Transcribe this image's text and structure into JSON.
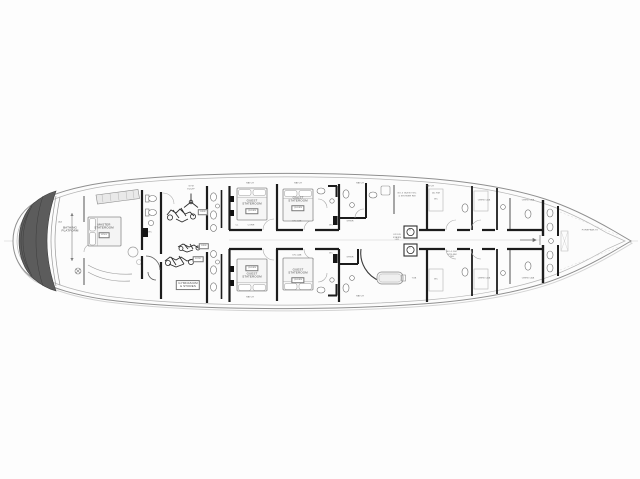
{
  "drawing": {
    "title": "yacht-lower-deck-plan",
    "colors": {
      "background": "#fdfdfd",
      "hull_line": "#8f8f8f",
      "hull_shadow": "#d4d4d4",
      "inner_line": "#b5b5b5",
      "bulkhead": "#1c1c1c",
      "partition": "#3c3c3c",
      "furniture": "#9c9c9c",
      "platform_fill": "#5c5c5c",
      "label_ink": "#4a4a4a"
    },
    "labels": [
      {
        "x": 60,
        "y": 223,
        "text": "LAZ",
        "boxed": false,
        "micro": true
      },
      {
        "x": 70,
        "y": 230,
        "text": "BATHING\nPLATFORM",
        "boxed": false,
        "micro": false
      },
      {
        "x": 104,
        "y": 227,
        "text": "MASTER\nSTATEROOM",
        "boxed": false,
        "micro": false
      },
      {
        "x": 104,
        "y": 235,
        "text": "KING",
        "boxed": true,
        "micro": true
      },
      {
        "x": 150,
        "y": 233,
        "text": "WC",
        "boxed": false,
        "micro": true
      },
      {
        "x": 191,
        "y": 188,
        "text": "GYM\nEQUIP",
        "boxed": false,
        "micro": true
      },
      {
        "x": 203,
        "y": 212,
        "text": "BIKE",
        "boxed": true,
        "micro": true
      },
      {
        "x": 204,
        "y": 246,
        "text": "BIKE",
        "boxed": true,
        "micro": true
      },
      {
        "x": 198,
        "y": 259,
        "text": "ROW",
        "boxed": true,
        "micro": true
      },
      {
        "x": 188,
        "y": 285,
        "text": "GYMNASIUM\n& STORES",
        "boxed": true,
        "micro": false
      },
      {
        "x": 237,
        "y": 226,
        "text": "CL",
        "boxed": false,
        "micro": true
      },
      {
        "x": 251,
        "y": 226,
        "text": "CORR",
        "boxed": false,
        "micro": true
      },
      {
        "x": 252,
        "y": 203,
        "text": "GUEST\nSTATEROOM",
        "boxed": false,
        "micro": false
      },
      {
        "x": 252,
        "y": 211,
        "text": "QUEEN",
        "boxed": true,
        "micro": true
      },
      {
        "x": 252,
        "y": 276,
        "text": "GUEST\nSTATEROOM",
        "boxed": false,
        "micro": false
      },
      {
        "x": 252,
        "y": 268,
        "text": "QUEEN",
        "boxed": true,
        "micro": true
      },
      {
        "x": 298,
        "y": 200,
        "text": "GUEST\nSTATEROOM",
        "boxed": false,
        "micro": false
      },
      {
        "x": 298,
        "y": 208,
        "text": "QUEEN",
        "boxed": true,
        "micro": true
      },
      {
        "x": 298,
        "y": 272,
        "text": "GUEST\nSTATEROOM",
        "boxed": false,
        "micro": false
      },
      {
        "x": 298,
        "y": 280,
        "text": "QUEEN",
        "boxed": true,
        "micro": true
      },
      {
        "x": 297,
        "y": 222,
        "text": "DN-CAB",
        "boxed": false,
        "micro": true
      },
      {
        "x": 297,
        "y": 256,
        "text": "DN-CAB",
        "boxed": false,
        "micro": true
      },
      {
        "x": 331,
        "y": 226,
        "text": "WC",
        "boxed": false,
        "micro": true
      },
      {
        "x": 331,
        "y": 254,
        "text": "WC",
        "boxed": false,
        "micro": true
      },
      {
        "x": 350,
        "y": 222,
        "text": "SHWR",
        "boxed": false,
        "micro": true
      },
      {
        "x": 350,
        "y": 258,
        "text": "SHWR",
        "boxed": false,
        "micro": true
      },
      {
        "x": 407,
        "y": 195,
        "text": "NO.3 GUEST WC\n& SHOWER RM",
        "boxed": false,
        "micro": true
      },
      {
        "x": 436,
        "y": 194,
        "text": "AC RM",
        "boxed": false,
        "micro": true
      },
      {
        "x": 397,
        "y": 238,
        "text": "UP-DN\nSTAIRS\nLBY",
        "boxed": false,
        "micro": true
      },
      {
        "x": 410,
        "y": 231,
        "text": "W",
        "boxed": false,
        "micro": true
      },
      {
        "x": 410,
        "y": 249,
        "text": "D",
        "boxed": false,
        "micro": true
      },
      {
        "x": 414,
        "y": 279,
        "text": "TUB",
        "boxed": false,
        "micro": true
      },
      {
        "x": 452,
        "y": 255,
        "text": "NO.4 GST\nSTR-RM\nDBL",
        "boxed": false,
        "micro": true
      },
      {
        "x": 484,
        "y": 201,
        "text": "CREW CAB",
        "boxed": false,
        "micro": true
      },
      {
        "x": 528,
        "y": 201,
        "text": "CREW CAB",
        "boxed": false,
        "micro": true
      },
      {
        "x": 484,
        "y": 279,
        "text": "CREW CAB",
        "boxed": false,
        "micro": true
      },
      {
        "x": 528,
        "y": 279,
        "text": "CREW CAB",
        "boxed": false,
        "micro": true
      },
      {
        "x": 436,
        "y": 200,
        "text": "WC",
        "boxed": false,
        "micro": true
      },
      {
        "x": 436,
        "y": 280,
        "text": "WC",
        "boxed": false,
        "micro": true
      },
      {
        "x": 590,
        "y": 231,
        "text": "FOREPEAK TK",
        "boxed": false,
        "micro": true
      },
      {
        "x": 250,
        "y": 184,
        "text": "HATCH",
        "boxed": false,
        "micro": true
      },
      {
        "x": 298,
        "y": 184,
        "text": "HATCH",
        "boxed": false,
        "micro": true
      },
      {
        "x": 360,
        "y": 184,
        "text": "HATCH",
        "boxed": false,
        "micro": true
      },
      {
        "x": 430,
        "y": 187,
        "text": "HATCH",
        "boxed": false,
        "micro": true
      },
      {
        "x": 250,
        "y": 298,
        "text": "HATCH",
        "boxed": false,
        "micro": true
      },
      {
        "x": 360,
        "y": 297,
        "text": "HATCH",
        "boxed": false,
        "micro": true
      }
    ]
  }
}
